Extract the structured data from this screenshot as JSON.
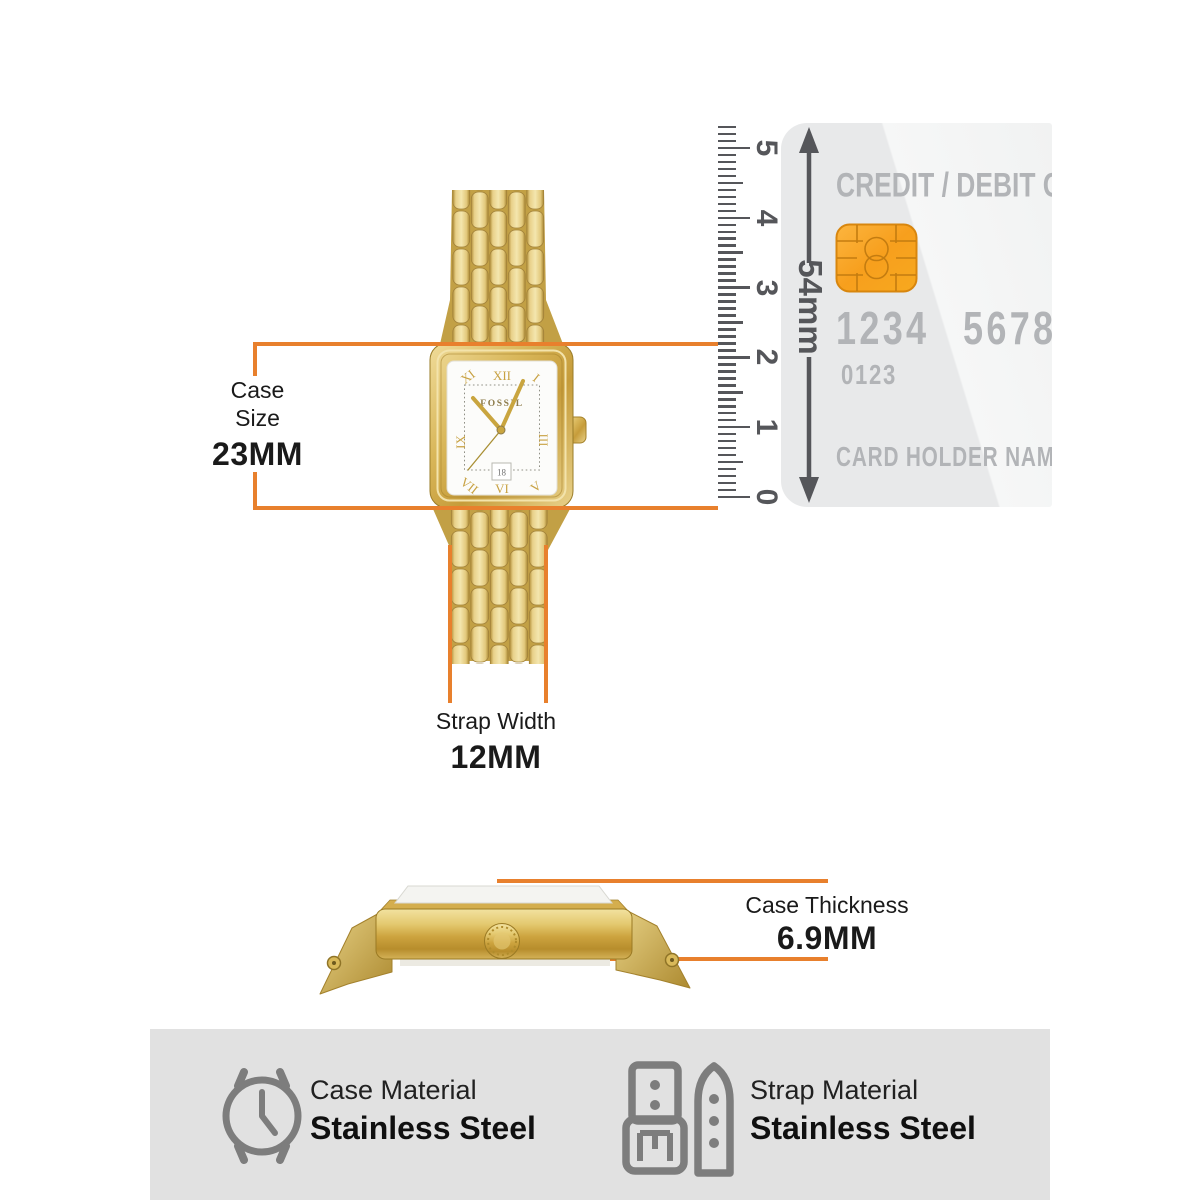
{
  "watch": {
    "brand": "FOSSIL",
    "date": "18",
    "numerals": {
      "h11": "XI",
      "h12": "XII",
      "h1": "I",
      "h9": "IX",
      "h3": "III",
      "h7": "VII",
      "h6": "VI",
      "h5": "V"
    }
  },
  "case_size": {
    "line1": "Case",
    "line2": "Size",
    "value": "23MM"
  },
  "strap_width": {
    "label": "Strap Width",
    "value": "12MM"
  },
  "case_thickness": {
    "label": "Case Thickness",
    "value": "6.9MM"
  },
  "ruler": {
    "numbers": [
      "0",
      "1",
      "2",
      "3",
      "4",
      "5"
    ]
  },
  "card": {
    "title": "CREDIT / DEBIT CARD",
    "number_left": "1234",
    "number_right": "5678",
    "expiry": "0123",
    "holder": "CARD HOLDER NAME",
    "height_label": "54mm"
  },
  "materials": {
    "case": {
      "label": "Case Material",
      "value": "Stainless Steel"
    },
    "strap": {
      "label": "Strap Material",
      "value": "Stainless Steel"
    }
  },
  "colors": {
    "accent_orange": "#E8802D",
    "ruler_gray": "#55565A",
    "card_text_gray": "#B2B4B7",
    "footer_bg": "#E1E1E1",
    "icon_gray": "#7D7D7D",
    "gold": "#D8B85F"
  }
}
